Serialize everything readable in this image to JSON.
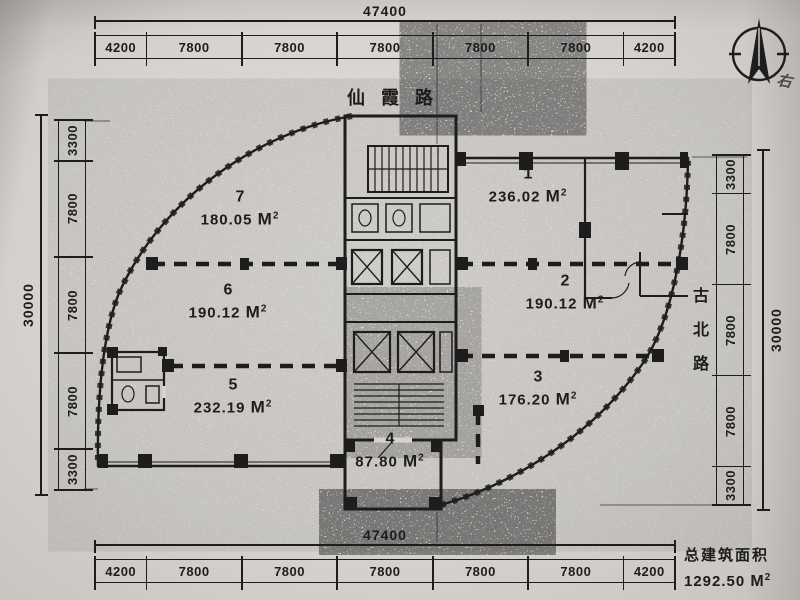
{
  "paper": {
    "bg": "#d7d4cf",
    "ink": "#1d1d1d"
  },
  "streets": {
    "top": "仙霞路",
    "right": [
      "古",
      "北",
      "路"
    ]
  },
  "north_arrow": "north-arrow",
  "annotation": {
    "text": "右"
  },
  "dimensions": {
    "top": {
      "total": "47400",
      "segments": [
        "4200",
        "7800",
        "7800",
        "7800",
        "7800",
        "7800",
        "4200"
      ]
    },
    "bottom": {
      "total": "47400",
      "segments": [
        "4200",
        "7800",
        "7800",
        "7800",
        "7800",
        "7800",
        "4200"
      ]
    },
    "left": {
      "total": "30000",
      "segments": [
        "3300",
        "7800",
        "7800",
        "7800",
        "3300"
      ]
    },
    "right": {
      "total": "30000",
      "segments": [
        "3300",
        "7800",
        "7800",
        "7800",
        "3300"
      ]
    }
  },
  "rooms": [
    {
      "number": "1",
      "area": "236.02",
      "unit": "M²"
    },
    {
      "number": "2",
      "area": "190.12",
      "unit": "M²"
    },
    {
      "number": "3",
      "area": "176.20",
      "unit": "M²"
    },
    {
      "number": "4",
      "area": "87.80",
      "unit": "M²"
    },
    {
      "number": "5",
      "area": "232.19",
      "unit": "M²"
    },
    {
      "number": "6",
      "area": "190.12",
      "unit": "M²"
    },
    {
      "number": "7",
      "area": "180.05",
      "unit": "M²"
    }
  ],
  "summary": {
    "label": "总建筑面积",
    "value": "1292.50",
    "unit": "M²"
  }
}
